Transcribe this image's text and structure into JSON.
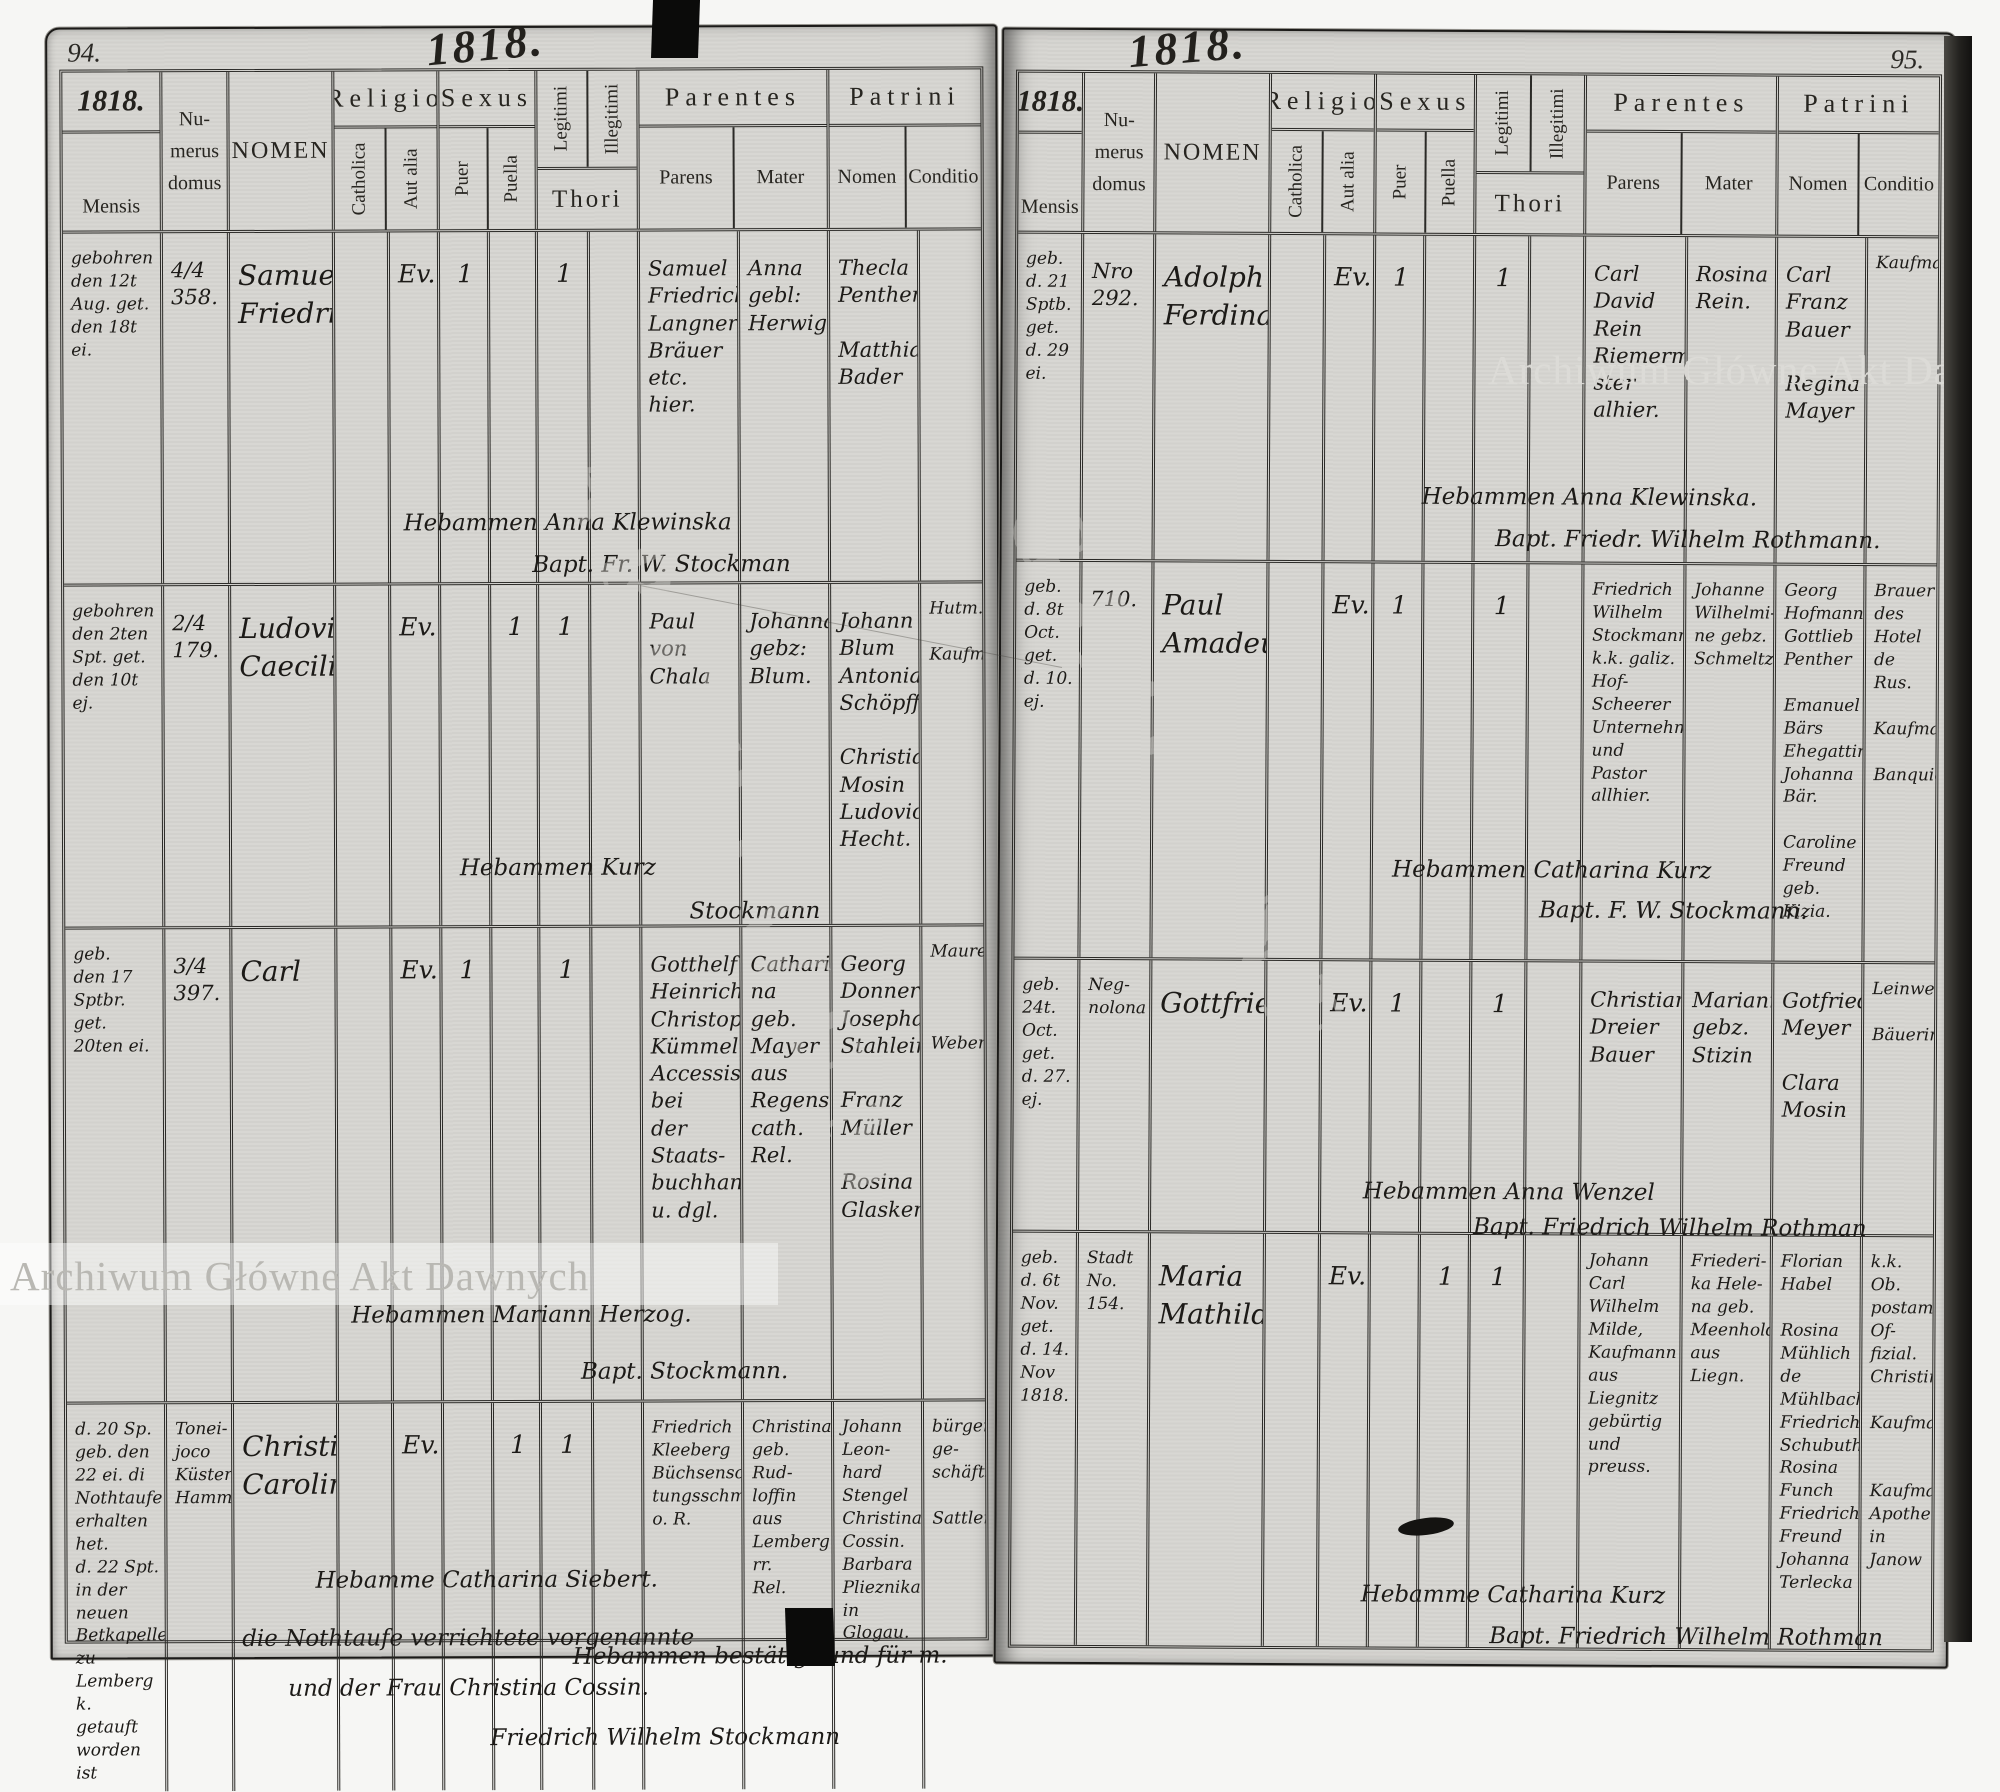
{
  "watermark": {
    "text": "Archiwum Główne Akt Dawnych"
  },
  "stamp_ghost": {
    "word1": "ARCHIWUM",
    "word2": "GŁÓWNE"
  },
  "header": {
    "mensis": "Mensis",
    "numerus": [
      "Nu-",
      "merus",
      "domus"
    ],
    "nomen": "NOMEN",
    "religio": "Religio",
    "catholica": "Catholica",
    "aut_alia": "Aut alia",
    "sexus": "Sexus",
    "puer": "Puer",
    "puella": "Puella",
    "legitimi": "Legitimi",
    "illegitimi": "Illegitimi",
    "thori": "Thori",
    "parentes": "Parentes",
    "parens": "Parens",
    "mater": "Mater",
    "patrini": "Patrini",
    "patrini_nomen": "Nomen",
    "conditio": "Conditio"
  },
  "pages": [
    {
      "number": "94.",
      "year_script": "1818.",
      "table_year": "1818.",
      "entries": [
        {
          "mensis": [
            "gebohren",
            "den 12t",
            "Aug. get.",
            "den 18t ei."
          ],
          "numerus": [
            "4/4",
            "358."
          ],
          "nomen": [
            "Samuel",
            "Friedrich"
          ],
          "catholica": "",
          "aut_alia": "Ev.",
          "puer": "1",
          "puella": "",
          "legitimi": "1",
          "illegitimi": "",
          "parens": [
            "Samuel",
            "Friedrich",
            "Langner",
            "Bräuer etc.",
            "hier."
          ],
          "mater": [
            "Anna",
            "gebl:",
            "Herwig"
          ],
          "patrini": [
            "Thecla",
            "Penther",
            "",
            "Matthias",
            "Bader"
          ],
          "conditio": [],
          "notes": [
            "Hebammen  Anna Klewinska",
            "Bapt. Fr.   W. Stockman"
          ]
        },
        {
          "mensis": [
            "gebohren",
            "den 2ten",
            "Spt. get.",
            "den 10t ej."
          ],
          "numerus": [
            "2/4",
            "179."
          ],
          "nomen": [
            "Ludovica",
            "Caecilie"
          ],
          "catholica": "",
          "aut_alia": "Ev.",
          "puer": "",
          "puella": "1",
          "legitimi": "1",
          "illegitimi": "",
          "parens": [
            "Paul",
            "von",
            "Chala"
          ],
          "mater": [
            "Johanna",
            "gebz:",
            "Blum."
          ],
          "patrini": [
            "Johann",
            "Blum",
            "Antonia",
            "Schöpff",
            "",
            "Christian",
            "Mosin",
            "Ludovica",
            "Hecht."
          ],
          "conditio": [
            "Hutm.",
            "",
            "Kaufm."
          ],
          "notes": [
            "Hebammen   Kurz",
            "Stockmann"
          ]
        },
        {
          "mensis": [
            "geb.",
            "den 17 Sptbr.",
            "get.",
            "20ten ei."
          ],
          "numerus": [
            "3/4",
            "397."
          ],
          "nomen": [
            "Carl"
          ],
          "catholica": "",
          "aut_alia": "Ev.",
          "puer": "1",
          "puella": "",
          "legitimi": "1",
          "illegitimi": "",
          "parens": [
            "Gotthelf",
            "Heinrich",
            "Christoph",
            "Kümmel",
            "Accessist bei",
            "der Staats-",
            "buchhandlung",
            "u. dgl."
          ],
          "mater": [
            "Cathari-",
            "na geb.",
            "Mayer aus",
            "Regensburg",
            "cath. Rel."
          ],
          "patrini": [
            "Georg",
            "Donner",
            "Josepha",
            "Stahlein",
            "",
            "Franz",
            "Müller",
            "",
            "Rosina",
            "Glasken"
          ],
          "conditio": [
            "Maurer",
            "",
            "",
            "",
            "Weber"
          ],
          "notes": [
            "Hebammen  Mariann Herzog.",
            "Bapt.    Stockmann."
          ]
        },
        {
          "mensis": [
            "d. 20 Sp.",
            "geb. den",
            "22 ei. di",
            "Nothtaufe",
            "erhalten het.",
            "d. 22 Spt.",
            "in der neuen",
            "Betkapelle zu",
            "Lemberg k.",
            "getauft",
            "worden ist"
          ],
          "numerus": [
            "Tonei-",
            "joco",
            "Küsters",
            "Hammer."
          ],
          "nomen": [
            "Christina",
            "Carolina."
          ],
          "catholica": "",
          "aut_alia": "Ev.",
          "puer": "",
          "puella": "1",
          "legitimi": "1",
          "illegitimi": "",
          "parens": [
            "Friedrich",
            "Kleeberg",
            "Büchsenschäf-",
            "tungsschmidt",
            "o. R."
          ],
          "mater": [
            "Christina",
            "geb. Rud-",
            "loffin aus",
            "Lemberg rr.",
            "Rel."
          ],
          "patrini": [
            "Johann Leon-",
            "hard Stengel",
            "Christina",
            "Cossin.",
            "Barbara",
            "Plieznika",
            "in Glogau."
          ],
          "conditio": [
            "bürgerl. ge-",
            "schäftsm.",
            "",
            "Sattler."
          ],
          "notes": [
            "Hebamme Catharina Siebert.",
            "die Nothtaufe verrichtete vorgenannte",
            "und der Frau Christina Cossin.",
            "Hebammen bestätigt und für m.",
            "Friedrich Wilhelm Stockmann"
          ]
        }
      ]
    },
    {
      "number": "95.",
      "year_script": "1818.",
      "table_year": "1818.",
      "entries": [
        {
          "mensis": [
            "geb.",
            "d. 21 Sptb.",
            "get.",
            "d. 29 ei."
          ],
          "numerus": [
            "Nro",
            "292."
          ],
          "nomen": [
            "Adolph",
            "Ferdinand"
          ],
          "catholica": "",
          "aut_alia": "Ev.",
          "puer": "1",
          "puella": "",
          "legitimi": "1",
          "illegitimi": "",
          "parens": [
            "Carl",
            "David",
            "Rein",
            "Riemermei-",
            "ster alhier."
          ],
          "mater": [
            "Rosina",
            "Rein."
          ],
          "patrini": [
            "Carl Franz",
            "Bauer",
            "",
            "Regina",
            "Mayer"
          ],
          "conditio": [
            "Kaufmann"
          ],
          "notes": [
            "Hebammen  Anna  Klewinska.",
            "Bapt.  Friedr. Wilhelm  Rothmann."
          ]
        },
        {
          "mensis": [
            "geb.",
            "d. 8t Oct.",
            "get.",
            "d. 10. ej."
          ],
          "numerus": [
            "710."
          ],
          "nomen": [
            "Paul",
            "Amadeus"
          ],
          "catholica": "",
          "aut_alia": "Ev.",
          "puer": "1",
          "puella": "",
          "legitimi": "1",
          "illegitimi": "",
          "parens": [
            "Friedrich",
            "Wilhelm",
            "Stockmann",
            "k.k. galiz.",
            "Hof-Scheerer",
            "Unternehmer",
            "und Pastor",
            "allhier."
          ],
          "mater": [
            "Johanne",
            "Wilhelmi-",
            "ne gebz.",
            "Schmeltz"
          ],
          "patrini": [
            "Georg",
            "Hofmann",
            "Gottlieb",
            "Penther",
            "",
            "Emanuel",
            "Bärs",
            "Ehegattin",
            "Johanna Bär.",
            "",
            "Caroline Freund",
            "geb. Kizia."
          ],
          "conditio": [
            "Brauer des",
            "Hotel de Rus.",
            "",
            "Kaufmann",
            "",
            "Banquier"
          ],
          "notes": [
            "Hebammen Catharina  Kurz",
            "Bapt.  F. W. Stockmann."
          ]
        },
        {
          "mensis": [
            "geb.",
            "24t.",
            "Oct.",
            "get.",
            "d. 27. ej."
          ],
          "numerus": [
            "Neg-",
            "nolona"
          ],
          "nomen": [
            "Gottfried"
          ],
          "catholica": "",
          "aut_alia": "Ev.",
          "puer": "1",
          "puella": "",
          "legitimi": "1",
          "illegitimi": "",
          "parens": [
            "Christian",
            "Dreier",
            "Bauer"
          ],
          "mater": [
            "Marianne",
            "gebz.",
            "Stizin"
          ],
          "patrini": [
            "Gotfried",
            "Meyer",
            "",
            "Clara",
            "Mosin"
          ],
          "conditio": [
            "Leinweber",
            "",
            "Bäuerin"
          ],
          "notes": [
            "Hebammen  Anna Wenzel",
            "Bapt.  Friedrich Wilhelm Rothman"
          ]
        },
        {
          "mensis": [
            "geb.",
            "d. 6t Nov.",
            "get.",
            "d. 14. Nov",
            "1818."
          ],
          "numerus": [
            "Stadt",
            "No.",
            "154."
          ],
          "nomen": [
            "Maria",
            "Mathilde"
          ],
          "catholica": "",
          "aut_alia": "Ev.",
          "puer": "",
          "puella": "1",
          "legitimi": "1",
          "illegitimi": "",
          "parens": [
            "Johann",
            "Carl",
            "Wilhelm",
            "Milde,",
            "Kaufmann",
            "aus Liegnitz",
            "gebürtig",
            "und preuss."
          ],
          "mater": [
            "Friederi-",
            "ka Hele-",
            "na geb.",
            "Meenholdt",
            "aus Liegn."
          ],
          "patrini": [
            "Florian",
            "Habel",
            "",
            "Rosina",
            "Mühlich",
            "de Mühlbach",
            "Friedrich",
            "Schubuth",
            "Rosina",
            "Funch",
            "Friedrich",
            "Freund",
            "Johanna",
            "Terlecka"
          ],
          "conditio": [
            "k.k. Ob.",
            "postamts Of-",
            "fizial.",
            "Christin",
            "",
            "Kaufmann",
            "",
            "",
            "Kaufmann",
            "Apothekerin",
            "in Janow"
          ],
          "notes": [
            "Hebamme Catharina  Kurz",
            "Bapt.  Friedrich Wilhelm Rothman"
          ]
        }
      ]
    }
  ]
}
